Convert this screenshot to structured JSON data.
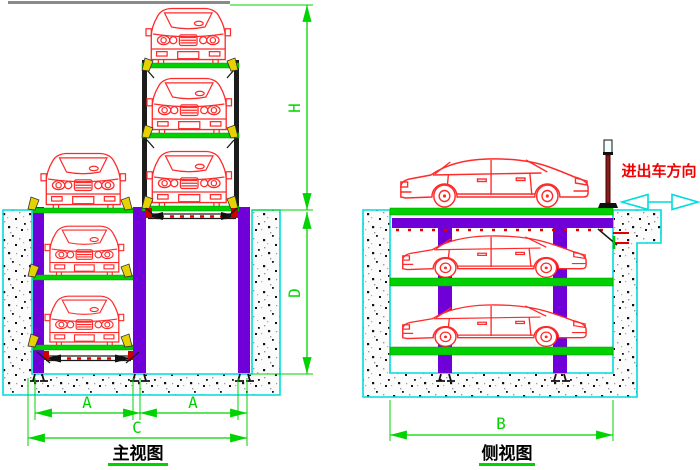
{
  "front_view": {
    "title": "主视图",
    "dims": {
      "h": "H",
      "d": "D",
      "a_left": "A",
      "a_right": "A",
      "c": "C"
    }
  },
  "side_view": {
    "title": "侧视图",
    "dims": {
      "b": "B"
    },
    "direction_label": "进出车方向"
  },
  "colors": {
    "car_outline": "#ff2a2a",
    "platform_green": "#00cf00",
    "column_purple": "#7000d8",
    "pit_outline_cyan": "#00dcdc",
    "dimension_green": "#00d400",
    "bracket_yellow": "#e6d200",
    "direction_text_red": "#f00000",
    "tower_frame_black": "#1c1c1c",
    "ceiling_gray": "#8a8a8a"
  }
}
